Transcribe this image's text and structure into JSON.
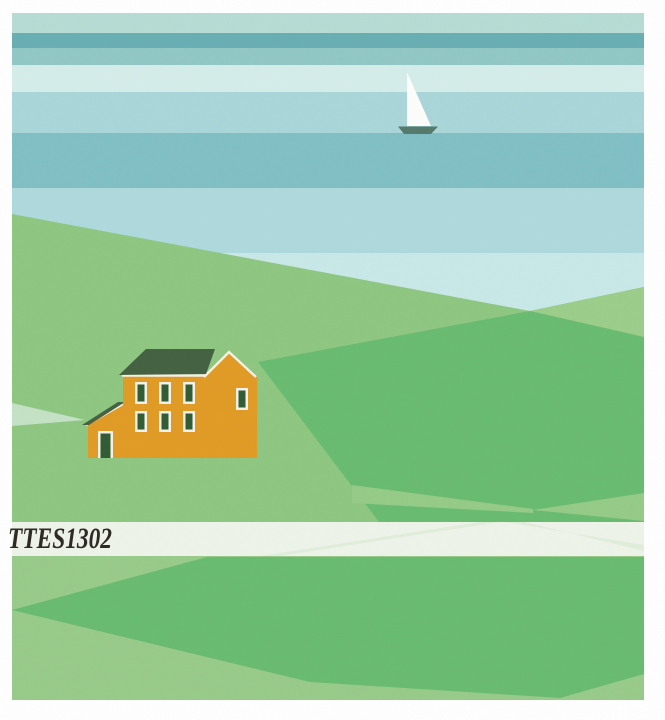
{
  "artwork": {
    "code": "TTES1302",
    "palette": {
      "page": "#ffffff",
      "stripe1": "#b5dcd4",
      "stripe2": "#67aeb2",
      "stripe3": "#90c7c5",
      "stripe4": "#d5edea",
      "stripe5": "#a9d6d9",
      "stripe6": "#7fbfc4",
      "stripe7": "#aed9dd",
      "stripe8": "#c8e8e8",
      "hill_left": "#8dc680",
      "hill_right": "#9bcd89",
      "green_dark": "#68bb70",
      "green_bottom": "#97ca89",
      "arm_light": "#94ca86",
      "pale_wedge": "#c4e2c5",
      "band": "#eef4ea",
      "band_tint": "#bfe0b4",
      "text": "#2f2a26",
      "house_wall": "#e19a23",
      "roof": "#42603f",
      "glass": "#2f5a31",
      "trim": "#f4f2e9",
      "sail": "#fdfdfb",
      "hull": "#53786a"
    }
  }
}
